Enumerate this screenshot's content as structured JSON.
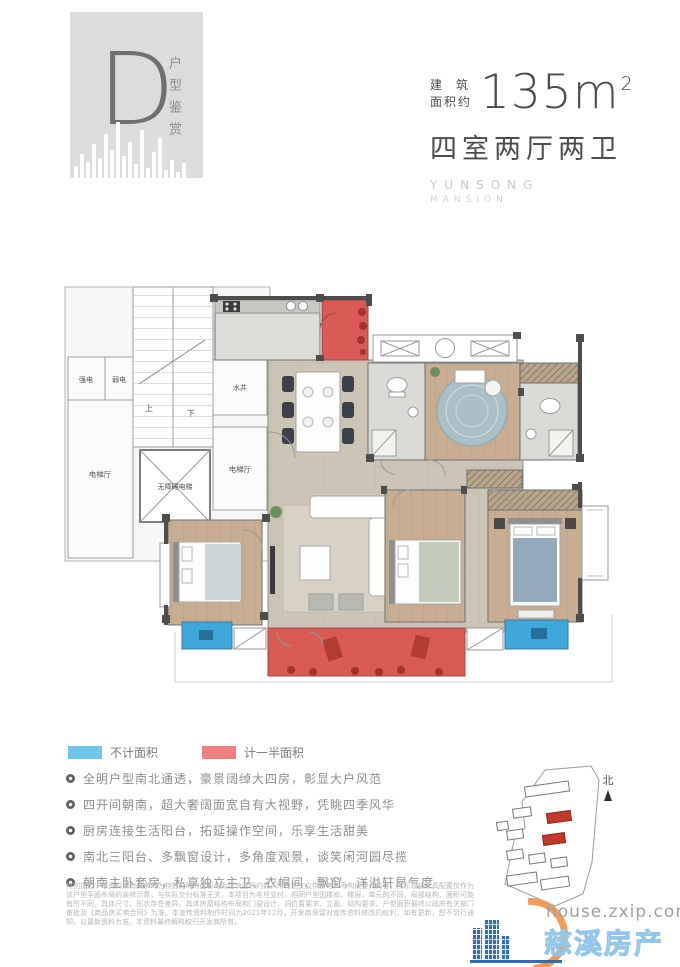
{
  "header": {
    "type_letter": "D",
    "type_caption": "户型鉴赏",
    "area_label_top": "建 筑",
    "area_label_bottom": "面积约",
    "area_value": "135m",
    "area_exponent": "2",
    "rooms_summary": "四室两厅两卫",
    "brand_top": "YUNSONG",
    "brand_bottom": "MANSION"
  },
  "plan": {
    "labels": {
      "strong_power": "强电",
      "weak_power": "弱电",
      "water_shaft": "水井",
      "up": "上",
      "down": "下",
      "elevator_hall_left": "电梯厅",
      "elevator_hall_right": "电梯厅",
      "accessible_elevator": "无障碍电梯"
    }
  },
  "legend": {
    "items": [
      {
        "label": "不计面积",
        "color": "#6ec6ea"
      },
      {
        "label": "计一半面积",
        "color": "#ee8080"
      }
    ]
  },
  "features": {
    "items": [
      "全明户型南北通透，豪景阔绰大四房，彰显大户风范",
      "四开间朝南，超大奢阔面宽自有大视野，凭眺四季风华",
      "厨房连接生活阳台，拓延操作空间，乐享生活甜美",
      "南北三阳台、多飘窗设计，多角度观景，谈笑闲河园尽揽",
      "朝南主卧套房，私享独立主卫、衣帽间、飘窗，洋溢轩昂气度"
    ]
  },
  "disclaimer": "特别提示：本资料所有文字均为特别说明的面积均为建筑面积约数，所有图文仅供参考，不构成要约内容，所示软装家具配置仅作为该户型平面布局的装修示意，与实际交付标准无关，本项目为毛坯交付。相同户型因楼栋、楼层、单元的不同，局部结构、面积可能有所不同，具体尺寸、形状存在差异。具体房屋结构布局和门窗设计、洞位置要求、立面、结构要求、户型面积最终以政府有关部门审批及《商品房买卖合同》为准。本宣传资料制作时间为2021年12月，开发商保留对宣传资料修改的权利，如有更新，恕不另行通知，以最新资料为准。本资料最终解释权归开发商所有。",
  "site_map": {
    "north_label": "北"
  },
  "watermark": {
    "domain": "house.zxip.com",
    "site_name": "慈溪房产网"
  }
}
